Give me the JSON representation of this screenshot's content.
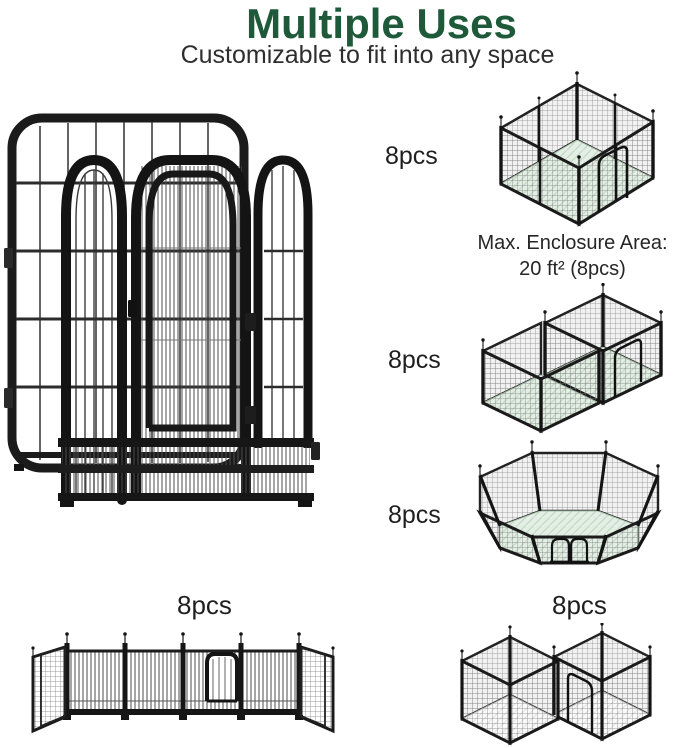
{
  "header": {
    "title": "Multiple Uses",
    "subtitle": "Customizable to fit into any space"
  },
  "configurations": {
    "square": {
      "pcs": "8pcs",
      "note_line1": "Max. Enclosure Area:",
      "note_line2": "20 ft² (8pcs)"
    },
    "l_shape": {
      "pcs": "8pcs"
    },
    "octagon": {
      "pcs": "8pcs"
    },
    "straight": {
      "pcs": "8pcs"
    },
    "zigzag": {
      "pcs": "8pcs"
    }
  },
  "colors": {
    "title_green": "#1e5a3a",
    "text_dark": "#2e2e2e",
    "frame_black": "#1a1a1a",
    "floor_mint": "#e3efe4"
  }
}
